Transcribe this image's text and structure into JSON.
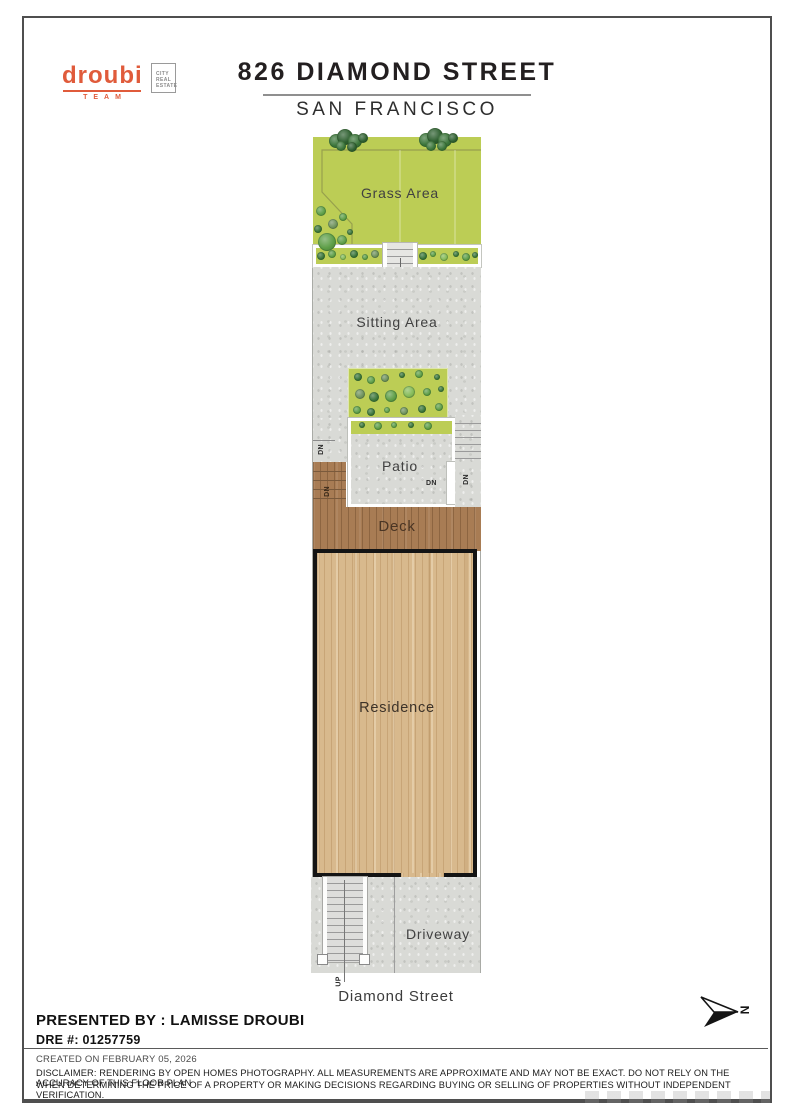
{
  "page": {
    "brand": {
      "logo_text": "droubi",
      "logo_sub": "TEAM",
      "badge_lines": [
        "CITY",
        "REAL",
        "ESTATE"
      ]
    },
    "header": {
      "title": "826 DIAMOND STREET",
      "subtitle": "SAN FRANCISCO"
    },
    "plan": {
      "areas": {
        "grass": "Grass Area",
        "sitting": "Sitting Area",
        "patio": "Patio",
        "deck": "Deck",
        "residence": "Residence",
        "driveway": "Driveway"
      },
      "street": "Diamond Street",
      "stair_up": "UP",
      "stair_down": "DN",
      "compass": "N",
      "colors": {
        "grass": "#bccd55",
        "concrete": "#d9dad6",
        "deck_wood": "#a87c54",
        "residence_floor": "#d8b98d",
        "outline_black": "#141414",
        "accent_orange": "#e05b3b",
        "bush_dark": "#3a7539",
        "bush_darker": "#2d5f2f",
        "bush_mid": "#5d9e47",
        "bush_light": "#85bb58",
        "bush_gray": "#6f925c"
      }
    },
    "footer": {
      "presented_by": "PRESENTED BY : LAMISSE DROUBI",
      "dre": "DRE #: 01257759",
      "created": "CREATED ON FEBRUARY 05, 2026",
      "disclaimer_line1": "DISCLAIMER: RENDERING BY OPEN HOMES PHOTOGRAPHY. ALL MEASUREMENTS ARE APPROXIMATE AND MAY NOT BE EXACT. DO NOT RELY ON THE ACCURACY OF THIS FLOOR PLAN",
      "disclaimer_line2": "WHEN DETERMINING THE PRICE OF A PROPERTY OR MAKING DECISIONS REGARDING BUYING OR SELLING OF PROPERTIES WITHOUT INDEPENDENT VERIFICATION."
    }
  }
}
